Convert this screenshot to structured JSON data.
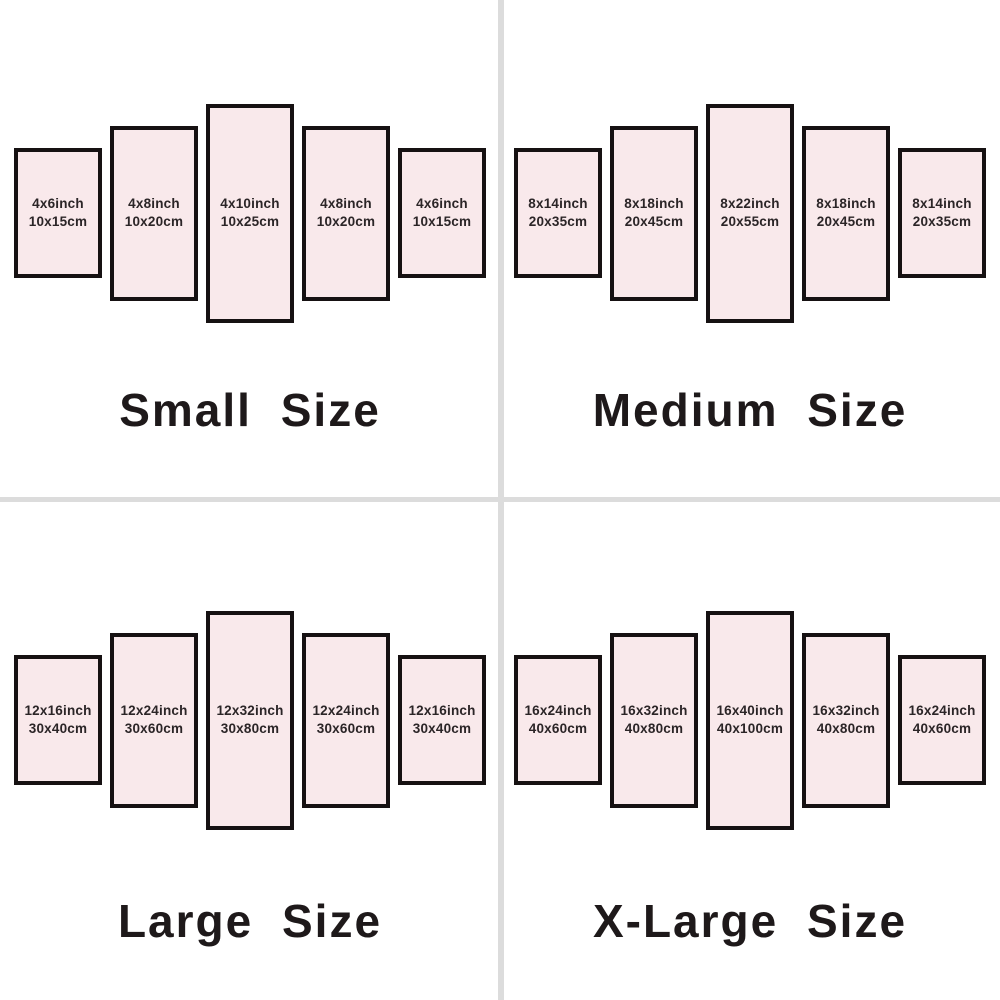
{
  "colors": {
    "background": "#ffffff",
    "divider": "#dcdcdc",
    "panel_fill": "#f9e9eb",
    "panel_border": "#161112",
    "text": "#2b2527"
  },
  "quadrants": [
    {
      "title": "Small Size",
      "panels": [
        {
          "inch": "4x6inch",
          "cm": "10x15cm"
        },
        {
          "inch": "4x8inch",
          "cm": "10x20cm"
        },
        {
          "inch": "4x10inch",
          "cm": "10x25cm"
        },
        {
          "inch": "4x8inch",
          "cm": "10x20cm"
        },
        {
          "inch": "4x6inch",
          "cm": "10x15cm"
        }
      ]
    },
    {
      "title": "Medium Size",
      "panels": [
        {
          "inch": "8x14inch",
          "cm": "20x35cm"
        },
        {
          "inch": "8x18inch",
          "cm": "20x45cm"
        },
        {
          "inch": "8x22inch",
          "cm": "20x55cm"
        },
        {
          "inch": "8x18inch",
          "cm": "20x45cm"
        },
        {
          "inch": "8x14inch",
          "cm": "20x35cm"
        }
      ]
    },
    {
      "title": "Large Size",
      "panels": [
        {
          "inch": "12x16inch",
          "cm": "30x40cm"
        },
        {
          "inch": "12x24inch",
          "cm": "30x60cm"
        },
        {
          "inch": "12x32inch",
          "cm": "30x80cm"
        },
        {
          "inch": "12x24inch",
          "cm": "30x60cm"
        },
        {
          "inch": "12x16inch",
          "cm": "30x40cm"
        }
      ]
    },
    {
      "title": "X-Large Size",
      "panels": [
        {
          "inch": "16x24inch",
          "cm": "40x60cm"
        },
        {
          "inch": "16x32inch",
          "cm": "40x80cm"
        },
        {
          "inch": "16x40inch",
          "cm": "40x100cm"
        },
        {
          "inch": "16x32inch",
          "cm": "40x80cm"
        },
        {
          "inch": "16x24inch",
          "cm": "40x60cm"
        }
      ]
    }
  ]
}
